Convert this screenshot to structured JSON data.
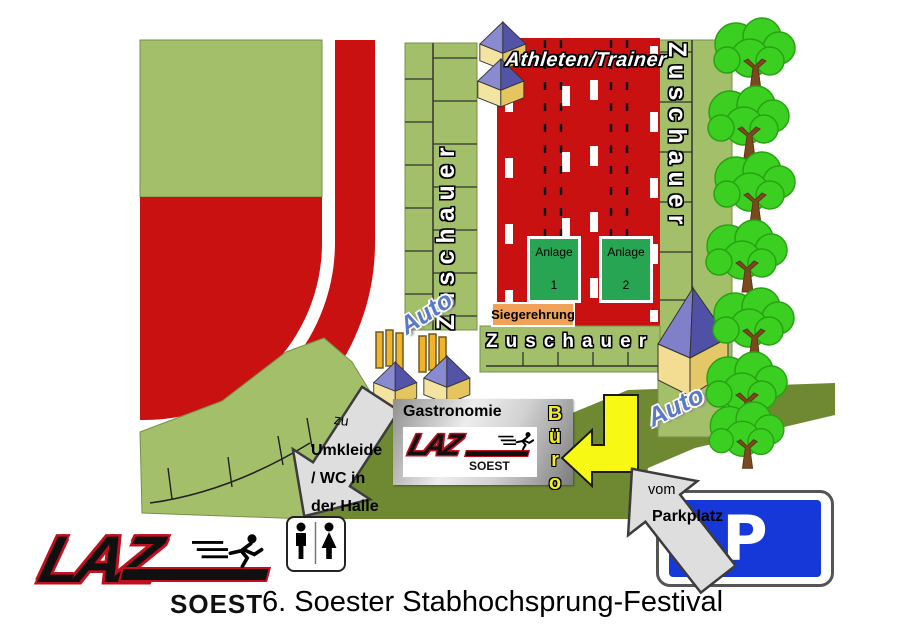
{
  "map": {
    "title": "6. Soester Stabhochsprung-Festival",
    "areas": {
      "athletes": "Athleten/Trainer",
      "spectators_left": "Zuschauer",
      "spectators_right": "Zuschauer",
      "spectators_bottom": "Zuschauer",
      "award_ceremony": "Siegerehrung",
      "catering": "Gastronomie",
      "office": "Büro",
      "car_left": "Auto",
      "car_right": "Auto",
      "facility1": {
        "label": "Anlage",
        "number": "1"
      },
      "facility2": {
        "label": "Anlage",
        "number": "2"
      }
    },
    "directions": {
      "changing_rooms": {
        "prefix": "zu",
        "line1": "Umkleide",
        "line2": "/ WC in",
        "line3": "der Halle"
      },
      "parking": {
        "prefix": "vom",
        "label": "Parkplatz"
      },
      "parking_sign": "P"
    },
    "logo": {
      "name": "LAZ",
      "city": "SOEST"
    }
  },
  "icons": {
    "tent": "tent-icon",
    "tree": "tree-icon",
    "wc": "wc-man-woman-icon",
    "runner": "runner-icon",
    "parking": "parking-sign-icon"
  },
  "colors": {
    "track_red": "#c91111",
    "field_green": "#a3bf69",
    "path_olive": "#6f8832",
    "facility_green": "#27a552",
    "award_orange": "#f2a258",
    "parking_blue": "#1738d8",
    "arrow_yellow": "#f8f815",
    "tree_green": "#3bcf21",
    "auto_blue": "#5b79cb",
    "logo_red": "#c01020"
  }
}
